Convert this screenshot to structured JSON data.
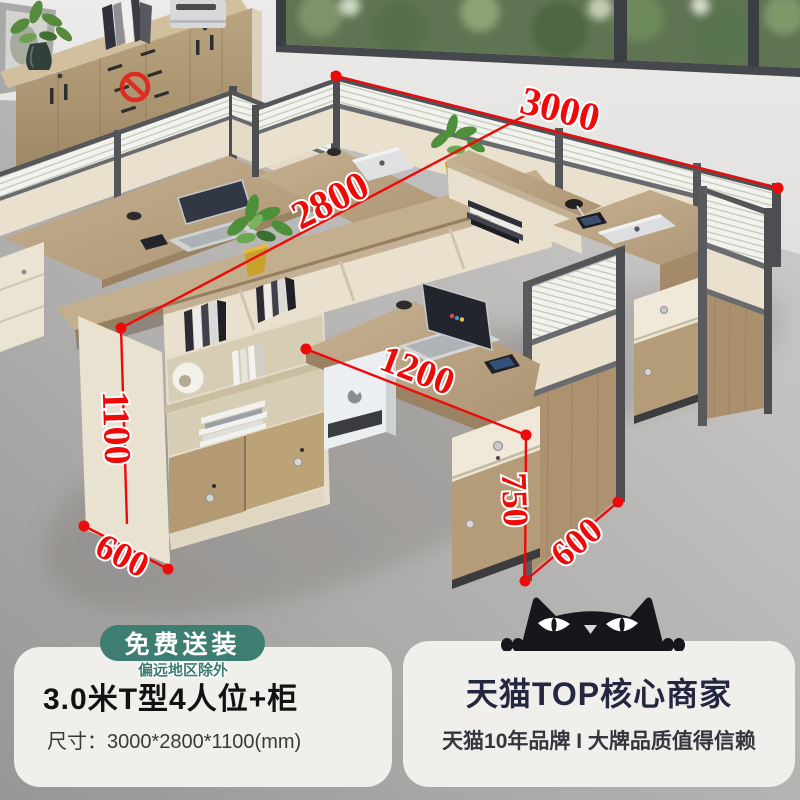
{
  "page": {
    "width": 800,
    "height": 800
  },
  "badge": {
    "label": "免费送装",
    "note": "偏远地区除外",
    "bg_color": "#3e7d72"
  },
  "product": {
    "title": "3.0米T型4人位+柜",
    "size_label": "尺寸：3000*2800*1100(mm)"
  },
  "seller": {
    "title": "天猫TOP核心商家",
    "subtitle": "天猫10年品牌 I 大牌品质值得信赖"
  },
  "dims": {
    "overall_width": "3000",
    "overall_depth": "2800",
    "cabinet_height": "1100",
    "cabinet_depth": "600",
    "desk_width": "1200",
    "pedestal_height": "750",
    "desk_depth": "600"
  },
  "colors": {
    "dimension_red": "#ef0a0a",
    "badge_green": "#3e7d72",
    "panel_bg": "#f1efec",
    "product_title": "#121212",
    "seller_title": "#242740",
    "wood": "#b9a284",
    "cream_panel": "#e9e1cd",
    "frame_gray": "#55565a"
  },
  "icons": {
    "prohibition": "no-entry-icon",
    "mascot": "tmall-cat-icon"
  }
}
